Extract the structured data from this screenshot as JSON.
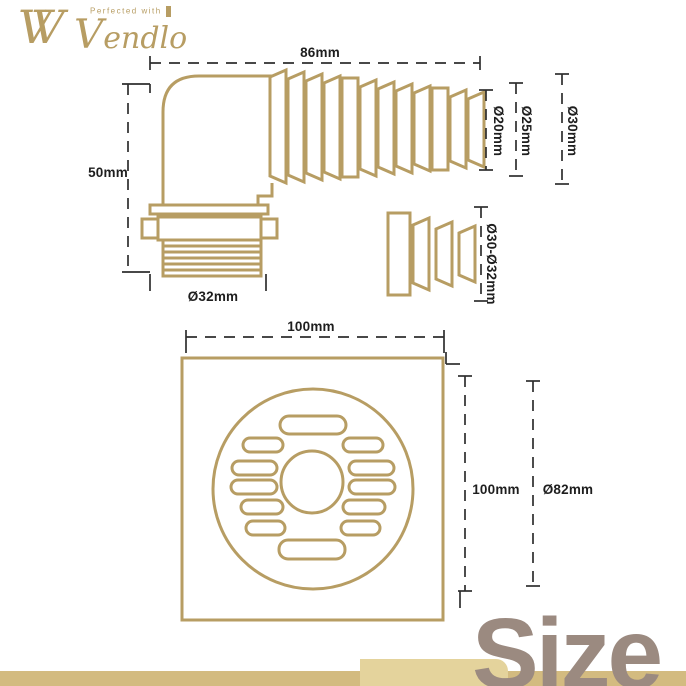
{
  "logo": {
    "monogram": "VV",
    "tagline": "Perfected with",
    "brand": "Vendlo"
  },
  "labels": {
    "elbow_width": "86mm",
    "elbow_height": "50mm",
    "thread_diameter": "Ø32mm",
    "hose_end_small": "Ø20mm",
    "hose_end_mid": "Ø25mm",
    "hose_end_large": "Ø30mm",
    "adapter_range": "Ø30-Ø32mm",
    "drain_width": "100mm",
    "drain_height": "100mm",
    "grate_circle": "Ø82mm"
  },
  "footer": {
    "size_word": "Size"
  },
  "colors": {
    "gold": "#b79d63",
    "dimension": "#2e2e2e",
    "size_text": "#9b8a80",
    "bar": "#d3bb80",
    "bar_light": "#e4d39c"
  }
}
